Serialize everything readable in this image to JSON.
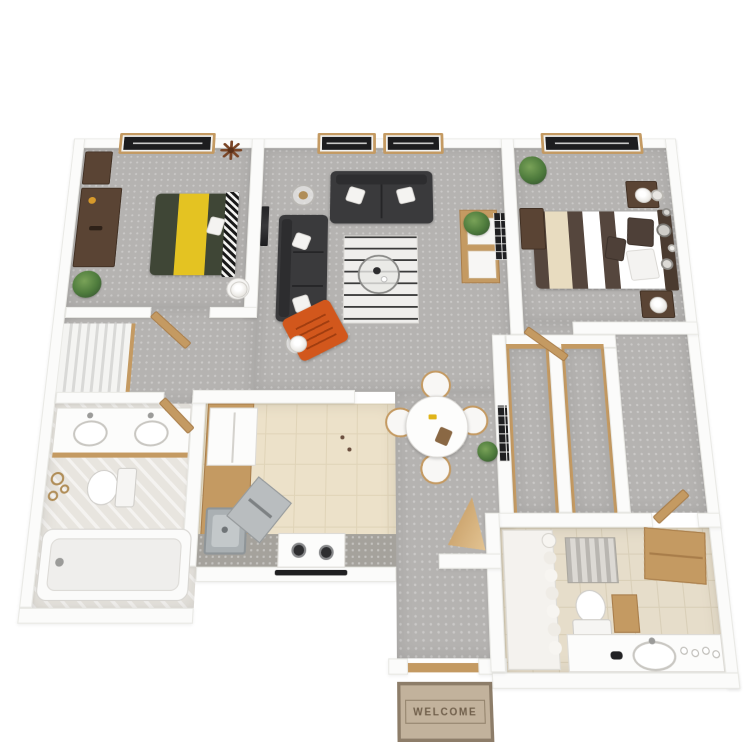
{
  "scene": {
    "type": "3d-floor-plan-render",
    "description": "Top-down 3D render of a two-bedroom, two-bathroom apartment floor plan on a white background",
    "background": "#ffffff"
  },
  "entry_mat": {
    "text": "WELCOME"
  },
  "palette": {
    "wall": "#fbfbfa",
    "wall_edge": "#e9e9e5",
    "carpet": "#b5b3b1",
    "kitchen_tile": "#ece1c9",
    "bath1_floor": "#e8e5df",
    "bath2_floor": "#e6ddca",
    "wood": "#c49a62",
    "wood_dark": "#a87d4a",
    "sofa": "#3a3a3c",
    "bed1_green": "#3f4636",
    "bed1_yellow": "#e4c322",
    "bed2_dark": "#55463d",
    "bed2_cream": "#e8dcc0",
    "headboard2": "#4a3b30",
    "accent_orange": "#d2571c",
    "rug_base": "#efeeec",
    "rug_stripe": "#3b3b3b",
    "glass": "#1d1d1f",
    "steel": "#aab0b3",
    "gold": "#b08d57",
    "plant": "#4d7a3c",
    "mat_bg": "#c2b29c",
    "mat_border": "#8d7d69",
    "mat_text": "#6f5e4a"
  },
  "rooms": {
    "bedroom_1": {
      "items": [
        "window",
        "starburst-wall-ornament",
        "desk",
        "dresser",
        "potted-plant",
        "bed-green-with-yellow-runner",
        "patterned-headboard",
        "round-nightstand-with-lamp",
        "wall-mounted-tv"
      ]
    },
    "living_room": {
      "items": [
        "window",
        "window",
        "black-loveseat",
        "black-sofa",
        "orange-accent-chair",
        "glass-side-table-with-candle",
        "glass-side-table-with-lamp",
        "striped-area-rug",
        "round-glass-coffee-table",
        "media-console",
        "wall-art",
        "potted-plant"
      ]
    },
    "bedroom_2": {
      "items": [
        "window",
        "bed-brown-white-striped",
        "headboard",
        "nightstand-with-lamp",
        "nightstand-with-lamp",
        "desk",
        "round-wall-decor-cluster",
        "potted-plant"
      ]
    },
    "bathroom_1": {
      "items": [
        "double-sink-vanity",
        "toilet",
        "bathtub",
        "gold-wall-decor",
        "louvered-linen-closet"
      ]
    },
    "kitchen": {
      "items": [
        "refrigerator",
        "wood-counter-run",
        "stainless-sink",
        "dishwasher",
        "range-with-two-burners"
      ]
    },
    "dining_area": {
      "items": [
        "round-dining-table",
        "dining-chair",
        "dining-chair",
        "dining-chair",
        "dining-chair",
        "potted-plant",
        "gallery-wall-art"
      ]
    },
    "hallway": {
      "items": [
        "reach-in-closet",
        "reach-in-closet",
        "open-door",
        "open-door"
      ]
    },
    "bathroom_2": {
      "items": [
        "shower-with-curtain",
        "striped-bath-mat",
        "tan-linen-cabinet",
        "toilet",
        "small-wood-cabinet",
        "vanity-with-sink-and-bottles"
      ]
    },
    "entry": {
      "items": [
        "door-opening",
        "welcome-mat",
        "open-door"
      ]
    }
  }
}
